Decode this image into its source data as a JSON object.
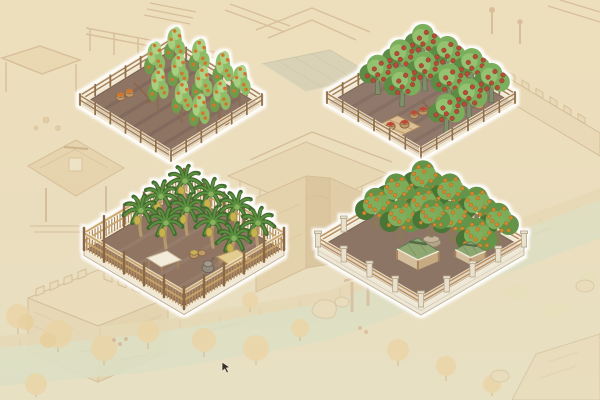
{
  "window": {
    "width": 600,
    "height": 400,
    "kind": "isometric town-builder game scene with four highlighted farm plots"
  },
  "scene": {
    "background": {
      "parchment_top": "#eedfbc",
      "parchment_bottom": "#e7e0c3",
      "sketch_line": "#c2a077",
      "sketch_fill": "#e6d2aa",
      "sketch_fill_dark": "#ddc091",
      "wall_fill": "#e8d6b0",
      "tower_fill": "#ecdcb8",
      "gray_roof": "#b8bdac",
      "river": "#d2dfc6",
      "embankment": "#e4d2ac",
      "grass": "#e0ddae",
      "autumn_foliage": "#ecca8c",
      "shrub": "#e4e1b4",
      "rock": "#e9dbb9",
      "pier_wood": "#c59277"
    },
    "glow": "#ffffff",
    "cursor": {
      "x": 222,
      "y": 362,
      "color": "#35312a"
    }
  },
  "prop_colors": {
    "basket": "#c19a67",
    "basket_line": "#8a6848",
    "rake": "#8a6848",
    "platform": "#dcbf92",
    "platform_line": "#a9845c",
    "canvas": "#f3ecda",
    "canvas_line": "#cfc0a2",
    "straw": "#e3cc8f",
    "straw_line": "#bfa268",
    "stone": "#93897b",
    "stone_light": "#a59a8a",
    "stone_line": "#6d6558",
    "pot": "#b5a488",
    "pot_rim": "#c4b59b",
    "pot_line": "#8f8066",
    "pav_roof": "#8fa871",
    "pav_roof_line": "#647c55",
    "pav_ridge": "#546c48",
    "pav_eave": "#f0ead6",
    "pav_post": "#a9845c",
    "pav_wall": "#d9c29e",
    "pav_wall_dark": "#c9ad83"
  },
  "plots": [
    {
      "id": "plot-fruit-saplings",
      "label": "fenced field of fruit saplings with orange fruit and harvest baskets",
      "geometry": {
        "cx": 171,
        "cy": 104,
        "hw": 91,
        "hh": 56
      },
      "fence": "rail",
      "style": {
        "soil": "#8e7464",
        "soil_dark": "#7c6356",
        "rim": "#f2e8d2",
        "edge_line": "#6f5b4a",
        "fence_glow": "#f4ecd9",
        "fence_wood": "#a8835a",
        "fence_post": "#8f6f4c"
      },
      "furrows": [
        0.18,
        0.34,
        0.5,
        0.66,
        0.82
      ],
      "tree": {
        "type": "sapling",
        "scale": 1.2,
        "mid": "#8fbc66",
        "light": "#aed287",
        "dark": "#6d9c4c",
        "trunk": "#8a6e52",
        "fruit": "#d0772e"
      },
      "trees": [
        [
          0.2,
          0.16
        ],
        [
          0.44,
          0.13
        ],
        [
          0.68,
          0.11
        ],
        [
          0.9,
          0.14
        ],
        [
          0.22,
          0.4
        ],
        [
          0.46,
          0.38
        ],
        [
          0.7,
          0.36
        ],
        [
          0.92,
          0.38
        ],
        [
          0.48,
          0.62
        ],
        [
          0.72,
          0.6
        ],
        [
          0.93,
          0.62
        ]
      ],
      "props": [
        {
          "type": "basket-pair",
          "u": 0.18,
          "v": 0.68,
          "fruit": "#d0772e"
        },
        {
          "type": "rake",
          "u": 0.3,
          "v": 0.6
        },
        {
          "type": "basket",
          "u": 0.95,
          "v": 0.36,
          "fruit": "#d0772e"
        }
      ]
    },
    {
      "id": "plot-red-fruit-orchard",
      "label": "fenced orchard of round trees with red fruit, baskets and drying platform",
      "geometry": {
        "cx": 421,
        "cy": 102,
        "hw": 94,
        "hh": 55
      },
      "fence": "rail",
      "style": {
        "soil": "#90786a",
        "soil_dark": "#7e685c",
        "rim": "#f2e8d2",
        "edge_line": "#6f5b4a",
        "fence_glow": "#f4ecd9",
        "fence_wood": "#a8835a",
        "fence_post": "#8f6f4c"
      },
      "furrows": [
        0.18,
        0.34,
        0.5,
        0.66,
        0.82
      ],
      "tree": {
        "type": "round",
        "scale": 1.15,
        "mid": "#7caf5c",
        "light": "#95c271",
        "dark": "#5d8c44",
        "trunk": "#7e8f69",
        "trunk_line": "#5a6b4c",
        "fruit": "#b84b38",
        "fruit_line": "#8c392b"
      },
      "trees": [
        [
          0.16,
          0.14
        ],
        [
          0.4,
          0.12
        ],
        [
          0.64,
          0.1
        ],
        [
          0.88,
          0.13
        ],
        [
          0.18,
          0.4
        ],
        [
          0.42,
          0.38
        ],
        [
          0.66,
          0.36
        ],
        [
          0.9,
          0.39
        ],
        [
          0.2,
          0.66
        ],
        [
          0.44,
          0.64
        ],
        [
          0.92,
          0.65
        ]
      ],
      "props": [
        {
          "type": "basket-pair",
          "u": 0.6,
          "v": 0.62,
          "fruit": "#bf4a36"
        },
        {
          "type": "rake",
          "u": 0.7,
          "v": 0.58
        },
        {
          "type": "basket",
          "u": 0.84,
          "v": 0.22,
          "fruit": "#bf4a36"
        },
        {
          "type": "platform",
          "u": 0.62,
          "v": 0.88,
          "fruit": "#bf4a36"
        }
      ]
    },
    {
      "id": "plot-banana-grove",
      "label": "banana grove with tall picket fence, canvas and straw awnings and stone mill",
      "geometry": {
        "cx": 184,
        "cy": 249,
        "hw": 100,
        "hh": 59
      },
      "fence": "picket",
      "base": "curb",
      "style": {
        "soil": "#8f7462",
        "soil_dark": "#7f6655",
        "furrow_color": "#9d8373",
        "rim": "#f2e8d2",
        "edge_line": "#6f5b4a",
        "fence_glow": "#f4ecd9",
        "fence_slat": "#b48c5a",
        "fence_rail": "#c9a468",
        "fence_post": "#8a6843",
        "base_fill": "#f1e9d7",
        "base_line": "#c2b195"
      },
      "furrows": [
        0.2,
        0.4,
        0.6,
        0.8
      ],
      "tree": {
        "type": "banana",
        "scale": 1.25,
        "mid": "#5d8f3f",
        "light": "#86b35b",
        "dark": "#3f6b2d",
        "trunk": "#b59a6d",
        "fruit": "#c8b24e",
        "fruit_line": "#a08b3c"
      },
      "trees": [
        [
          0.14,
          0.13
        ],
        [
          0.38,
          0.11
        ],
        [
          0.62,
          0.09
        ],
        [
          0.86,
          0.12
        ],
        [
          0.15,
          0.38
        ],
        [
          0.39,
          0.36
        ],
        [
          0.63,
          0.34
        ],
        [
          0.87,
          0.37
        ],
        [
          0.17,
          0.6
        ],
        [
          0.4,
          0.58
        ]
      ],
      "props": [
        {
          "type": "awning-white",
          "u": 0.56,
          "v": 0.76
        },
        {
          "type": "mill",
          "u": 0.8,
          "v": 0.56
        },
        {
          "type": "awning-straw",
          "u": 0.9,
          "v": 0.4
        },
        {
          "type": "basket-stack",
          "u": 0.61,
          "v": 0.49,
          "fruit": "#c8b24e"
        }
      ]
    },
    {
      "id": "plot-orange-orchard",
      "label": "dense orange orchard on stone base with green-roofed pavilions and potted tree",
      "geometry": {
        "cx": 421,
        "cy": 246,
        "hw": 103,
        "hh": 60
      },
      "fence": "stone-rail",
      "base": "stone",
      "style": {
        "soil": "#8d7566",
        "soil_dark": "#7c6457",
        "rim": "#f0e9d6",
        "edge_line": "#6f5b4a",
        "fence_glow": "#f4ecd9",
        "fence_wood": "#b98f60",
        "pillar": "#e9e1cc",
        "pillar_line": "#b3a78a",
        "base_fill": "#eee7d6",
        "base_line": "#c2b79c"
      },
      "furrows": [],
      "tree": {
        "type": "orange",
        "scale": 1.15,
        "mid": "#639446",
        "light": "#7fae5b",
        "dark": "#4a7436",
        "trunk": "#8a7a58",
        "fruit": "#d0892f",
        "fruit_line": "#a5681f"
      },
      "trees": [
        [
          0.14,
          0.12
        ],
        [
          0.38,
          0.1
        ],
        [
          0.62,
          0.08
        ],
        [
          0.86,
          0.11
        ],
        [
          0.12,
          0.36
        ],
        [
          0.36,
          0.34
        ],
        [
          0.62,
          0.32
        ],
        [
          0.88,
          0.34
        ],
        [
          0.14,
          0.58
        ],
        [
          0.36,
          0.56
        ]
      ],
      "props": [
        {
          "type": "planter-tree",
          "u": 0.52,
          "v": 0.42
        },
        {
          "type": "pavilion",
          "u": 0.62,
          "v": 0.65,
          "s": 1.1
        },
        {
          "type": "pavilion",
          "u": 0.85,
          "v": 0.37,
          "s": 0.8
        }
      ]
    }
  ]
}
